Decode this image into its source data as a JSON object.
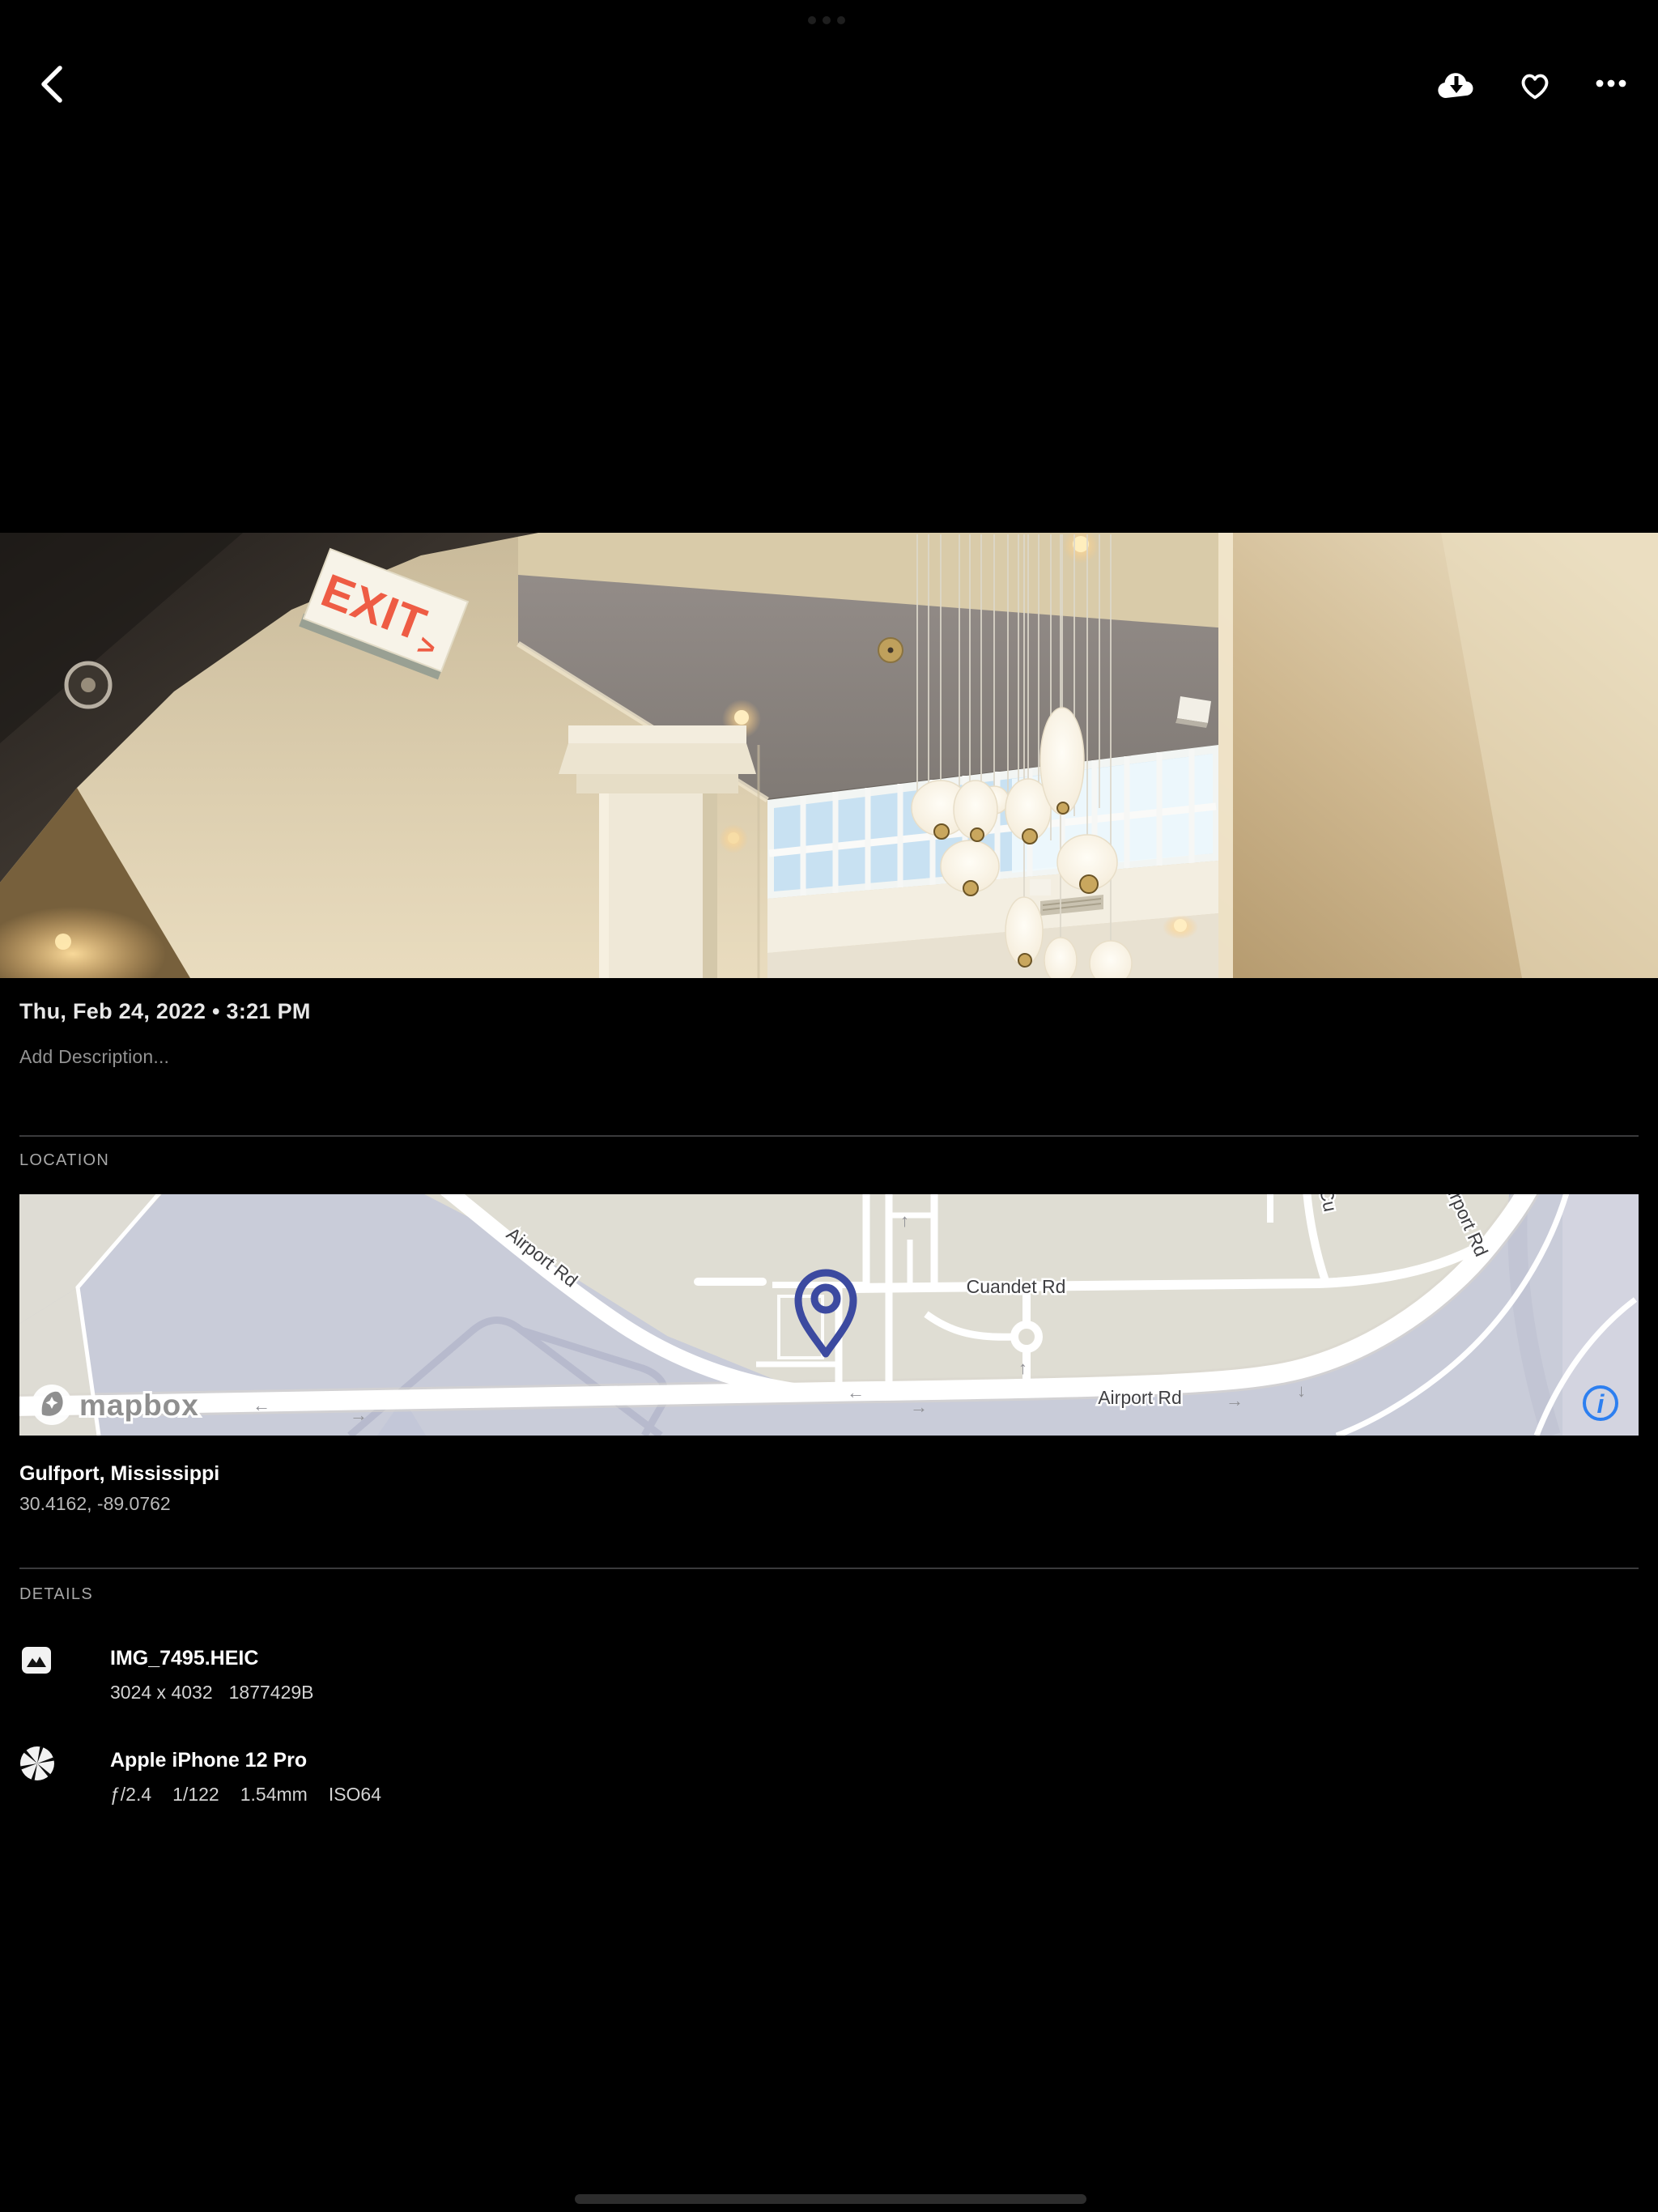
{
  "system": {
    "multitask_indicator": "ellipsis-handle",
    "home_indicator": "home-handle"
  },
  "toolbar": {
    "back_icon": "chevron-left",
    "download_icon": "cloud-download",
    "favorite_icon": "heart-outline",
    "more_icon": "ellipsis"
  },
  "photo": {
    "exit_sign": {
      "text": "EXIT",
      "arrow": ">"
    }
  },
  "meta": {
    "datetime": "Thu, Feb 24, 2022 • 3:21 PM",
    "description_placeholder": "Add Description..."
  },
  "location": {
    "header": "LOCATION",
    "place": "Gulfport, Mississippi",
    "coordinates": "30.4162, -89.0762",
    "map": {
      "attribution": "mapbox",
      "info_label": "i",
      "road_labels": {
        "airport_diagonal": "Airport Rd",
        "cuandet": "Cuandet Rd",
        "airport_horizontal": "Airport Rd",
        "airport_upper_right": "Airport Rd",
        "cross_street": "Cu"
      },
      "arrows": {
        "left": "←",
        "right": "→",
        "up": "↑",
        "down": "↓"
      }
    }
  },
  "details": {
    "header": "DETAILS",
    "rows": [
      {
        "icon": "image-icon",
        "title": "IMG_7495.HEIC",
        "meta_parts": [
          "3024 x 4032",
          "1877429B"
        ]
      },
      {
        "icon": "aperture-icon",
        "title": "Apple iPhone 12 Pro",
        "meta_parts": [
          "ƒ/2.4",
          "1/122",
          "1.54mm",
          "ISO64"
        ]
      }
    ]
  },
  "colors": {
    "background": "#000000",
    "accent_blue": "#2d7ff0",
    "pin_indigo": "#3c4aa0",
    "exit_red": "#ee5c44",
    "divider": "#3a3a3c"
  }
}
